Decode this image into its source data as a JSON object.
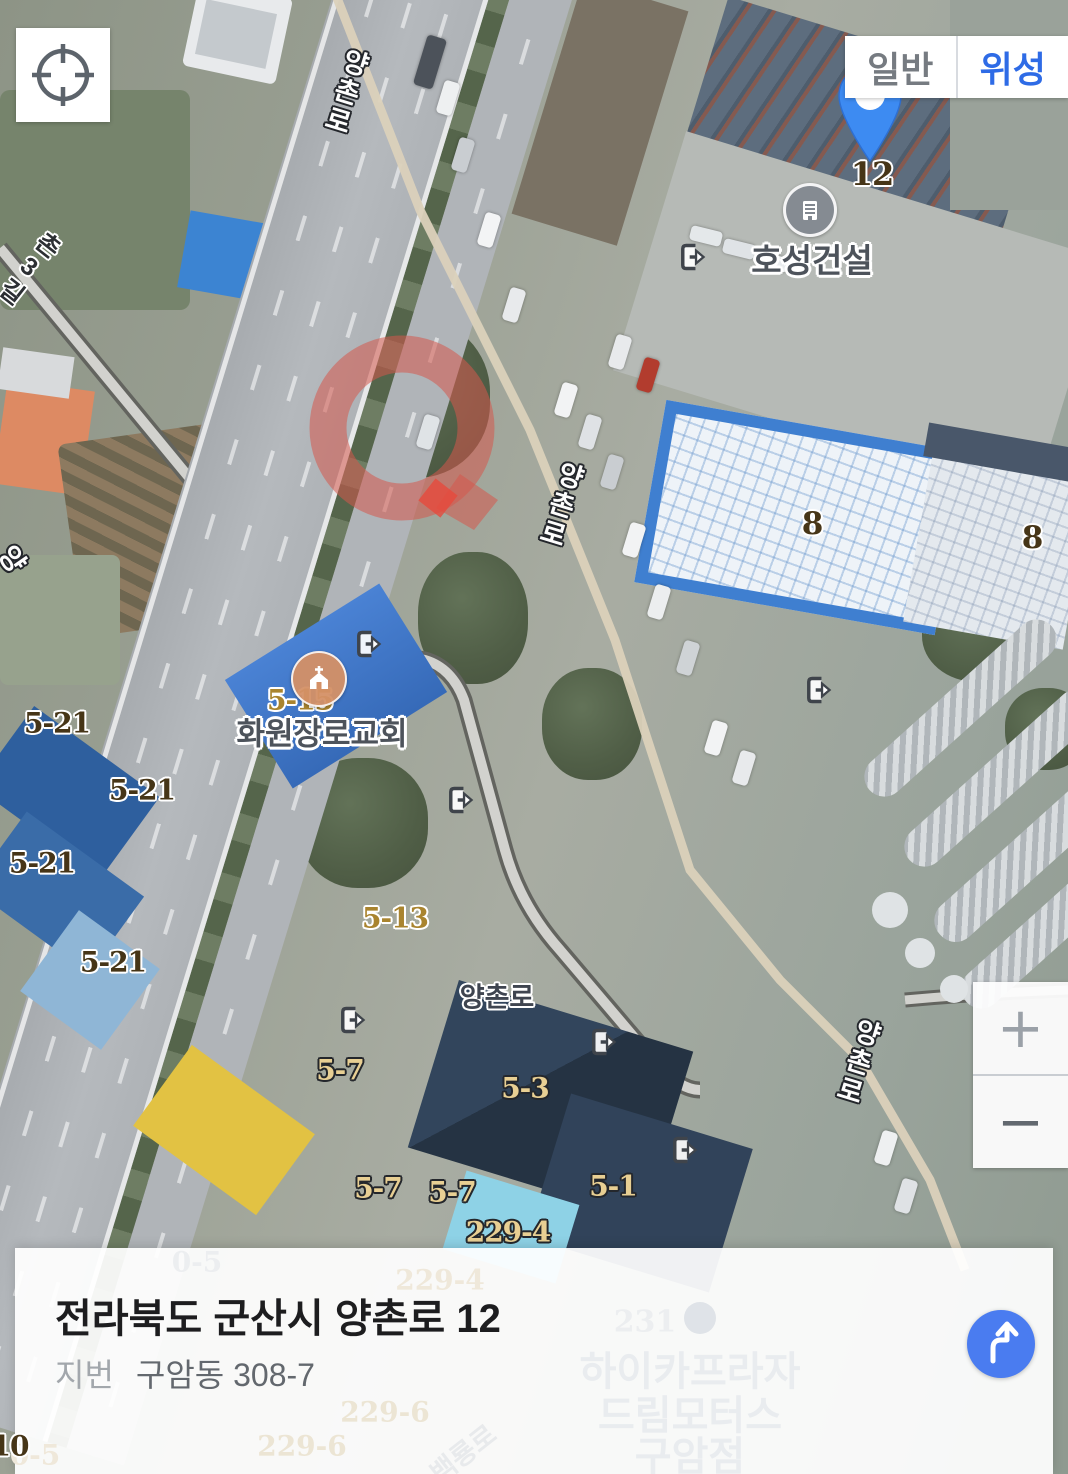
{
  "controls": {
    "locate_button_icon": "crosshair-icon",
    "map_type_toggle": {
      "normal": "일반",
      "satellite": "위성",
      "active": "위성"
    },
    "zoom_control": {
      "zoom_in": "+",
      "zoom_out": "−"
    },
    "directions_button_icon": "route-arrow-icon"
  },
  "marker_pin": {
    "label": "12",
    "color": "#3d8bf2"
  },
  "target_marker": {
    "shape": "red-ring-with-tail",
    "color": "#d95a4e"
  },
  "pois": {
    "construction": {
      "name": "호성건설",
      "icon": "building-icon"
    },
    "church": {
      "name": "화원장로교회",
      "icon": "church-icon"
    }
  },
  "road_labels": {
    "yangchon_top": "양촌로",
    "yangchon_mid": "양촌로",
    "yangchon_bottom": "양촌로",
    "yangchon_horizontal": "양촌로",
    "chon3gil": "촌3길",
    "partial_left": "양"
  },
  "lot_labels": {
    "l521a": "5-21",
    "l521b": "5-21",
    "l521c": "5-21",
    "l521d": "5-21",
    "l515": "5-15",
    "l513": "5-13",
    "l57a": "5-7",
    "l57b": "5-7",
    "l57c": "5-7",
    "l53": "5-3",
    "l51": "5-1",
    "l2294": "229-4",
    "l8a": "8",
    "l8b": "8",
    "l10": "10"
  },
  "address_panel": {
    "road_address": "전라북도 군산시 양촌로 12",
    "jibun_label": "지번",
    "jibun_value": "구암동 308-7"
  },
  "background_labels": {
    "b05a": "0-5",
    "b2294": "229-4",
    "b231": "231",
    "hicar": "하이카프라자",
    "dream": "드림모터스",
    "guam": "구암점",
    "b2296a": "229-6",
    "b2296b": "229-6",
    "baekryong": "백룡로",
    "b05b": "0-5"
  },
  "icons": {
    "entrance": "entrance-arrow-icon",
    "faint_poi": "wrench-icon"
  },
  "colors": {
    "satellite_button_active": "#2e6be6",
    "normal_button": "#767b81",
    "pin_blue": "#3d8bf2",
    "target_marker_red": "#d95a4e",
    "directions_button_blue": "#4a7cf0",
    "lot_text_dark": "#463517",
    "lot_text_gold": "#e8cf93"
  }
}
